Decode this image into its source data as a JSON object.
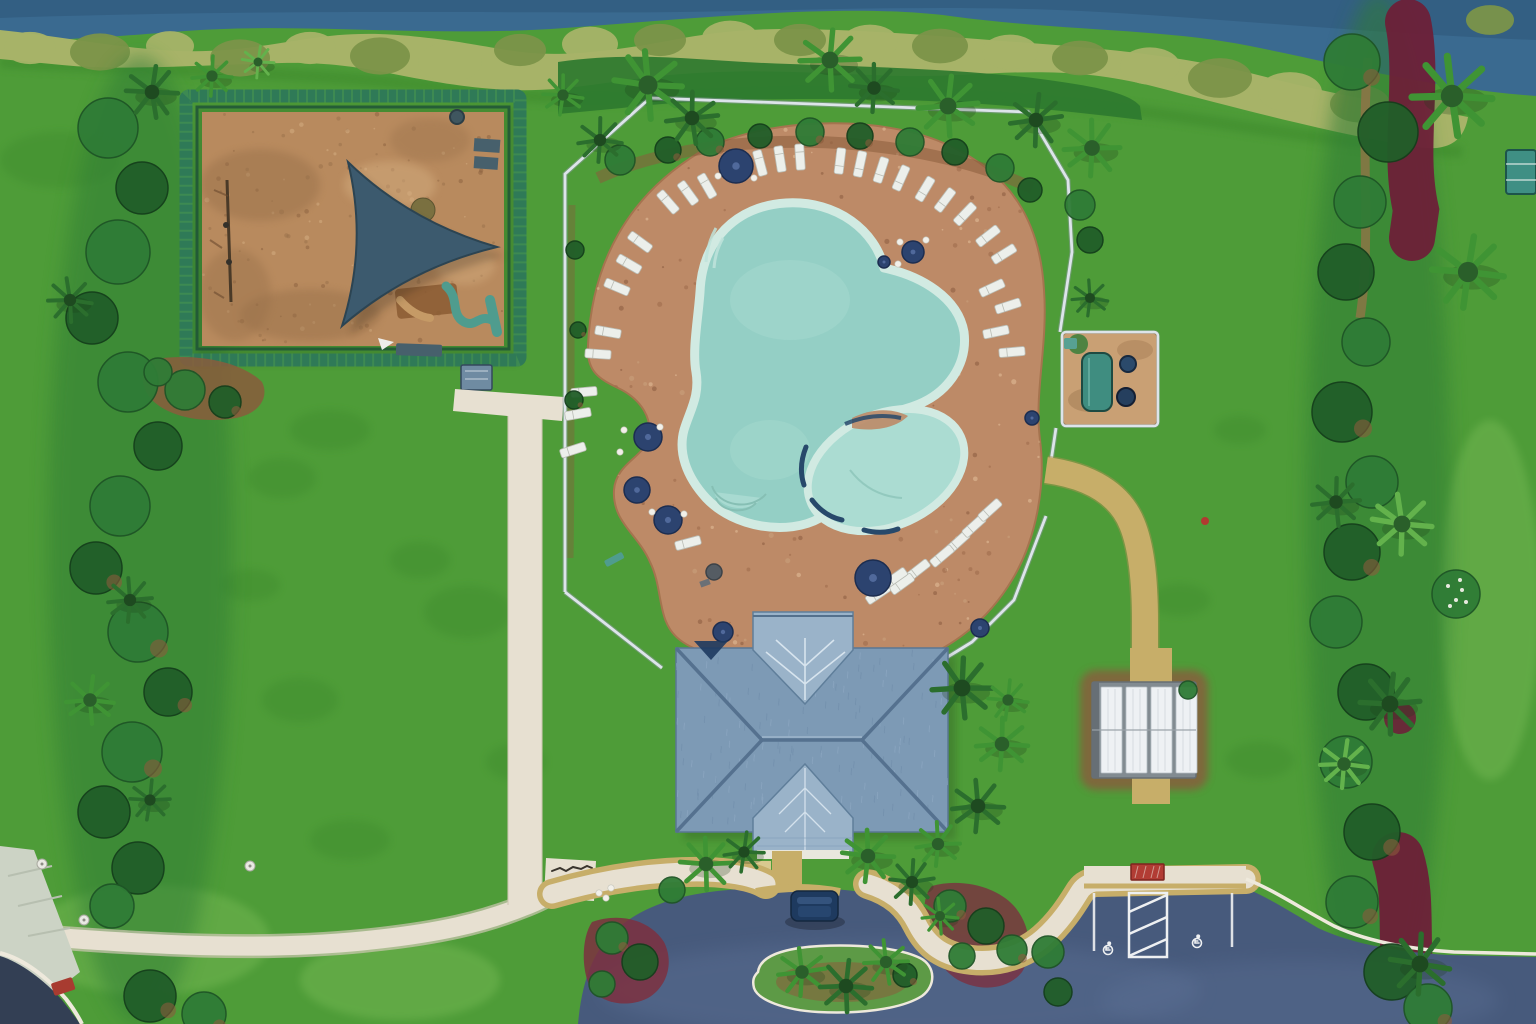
{
  "meta": {
    "width": 1536,
    "height": 1024,
    "scene": "aerial-drone-photo",
    "subject": "community amenity center: free-form pool with paver deck and lounge chairs, playground with shade sail, hip-roof clubhouse, mail pavilion, equipment enclosure, parking lot with accessible stalls, lawns, hedges and canal"
  },
  "palette": {
    "grass": "#4e9c38",
    "grassLight": "#65b148",
    "grassDark": "#3a872c",
    "grassPale": "#7cbd58",
    "water": "#3a6a90",
    "waterDark": "#2d5578",
    "hedge": "#a7b368",
    "hedgeDark": "#7b9449",
    "denseHedge": "#2e7a2f",
    "shrub": "#2f7c36",
    "shrubDark": "#215e29",
    "shrubLight": "#5aa84a",
    "palm": "#3f9434",
    "palmDark": "#2b6e2d",
    "palmLight": "#63b24c",
    "mulch": "#8a5c3c",
    "mulchRed": "#7c3040",
    "burgundy": "#6d2038",
    "dirt": "#9b7148",
    "playMulch": "#b88a5e",
    "playMulchDark": "#97704a",
    "playMulchLight": "#d3ac7e",
    "playHedge": "#2f7a57",
    "playHedgeDark": "#1d5038",
    "sail": "#3c5a6e",
    "sailShadow": "#2c4452",
    "equipTeal": "#4f9c8e",
    "equipBrown": "#8a5a33",
    "benchSlate": "#47606c",
    "gateBlue": "#6f8ba2",
    "deck": "#bd8a67",
    "deckDark": "#9c6a4b",
    "deckLight": "#e3c09b",
    "poolWater": "#94cfc5",
    "poolWaterLight": "#abdcd2",
    "coping": "#d1eae2",
    "spaRim": "#27496b",
    "poolStep": "#bfe3da",
    "fence": "#dde4ea",
    "fenceShadow": "#8d9aa3",
    "sidewalk": "#e7e0d1",
    "sidewalkEdge": "#cfc7b4",
    "pathTan": "#c7ae69",
    "pathTanDark": "#a98f4f",
    "asphalt": "#475a7c",
    "asphaltLight": "#60759a",
    "roadDark": "#333f54",
    "curb": "#eee9dc",
    "stripe": "#eef0f2",
    "carNavy": "#1e3a5f",
    "carNavyLight": "#3a5a85",
    "navy": "#2c436f",
    "navyDark": "#1c2d50",
    "lounger": "#ecefeb",
    "loungerEdge": "#b9bcb4",
    "roof": "#7d9ab5",
    "roofLight": "#9ab3c9",
    "roofDark": "#55718f",
    "roofVein": "#dee9f2",
    "wallWhite": "#e9e7dd",
    "pavFrame": "#828b91",
    "pavPanel": "#eef1f4",
    "pavPanelLine": "#b6bfc5",
    "sand": "#c9a074",
    "tealUnit": "#3f8d80",
    "redSign": "#b23c34",
    "redObj": "#a83b30",
    "tableTeal": "#3f8f84",
    "grillGray": "#555c63",
    "white": "#f2f0e9"
  },
  "objects": {
    "loungers": [
      [
        668,
        202,
        49
      ],
      [
        688,
        193,
        54
      ],
      [
        707,
        186,
        60
      ],
      [
        760,
        163,
        75
      ],
      [
        780,
        159,
        81
      ],
      [
        800,
        157,
        86
      ],
      [
        840,
        161,
        -83
      ],
      [
        860,
        164,
        -78
      ],
      [
        881,
        170,
        -72
      ],
      [
        901,
        178,
        -66
      ],
      [
        925,
        189,
        -59
      ],
      [
        945,
        200,
        -53
      ],
      [
        965,
        214,
        -46
      ],
      [
        988,
        236,
        -38
      ],
      [
        1004,
        254,
        -32
      ],
      [
        992,
        288,
        -25
      ],
      [
        1008,
        306,
        -18
      ],
      [
        996,
        332,
        -12
      ],
      [
        1012,
        352,
        -5
      ],
      [
        640,
        242,
        36
      ],
      [
        629,
        264,
        30
      ],
      [
        617,
        287,
        23
      ],
      [
        608,
        332,
        10
      ],
      [
        598,
        354,
        4
      ],
      [
        584,
        392,
        -5
      ],
      [
        578,
        414,
        -10
      ],
      [
        573,
        450,
        -18
      ],
      [
        688,
        543,
        -15
      ],
      [
        958,
        542,
        -42
      ],
      [
        974,
        526,
        -42
      ],
      [
        990,
        510,
        -42
      ],
      [
        942,
        556,
        -40
      ],
      [
        918,
        570,
        -38
      ],
      [
        902,
        584,
        -36
      ],
      [
        878,
        594,
        -34
      ],
      [
        895,
        578,
        -35
      ]
    ],
    "umbrellas": [
      [
        736,
        166,
        17
      ],
      [
        648,
        437,
        14
      ],
      [
        637,
        490,
        13
      ],
      [
        668,
        520,
        14
      ],
      [
        873,
        578,
        18
      ],
      [
        723,
        632,
        10
      ],
      [
        980,
        628,
        9
      ],
      [
        913,
        252,
        11
      ],
      [
        884,
        262,
        6
      ],
      [
        1032,
        418,
        7
      ]
    ],
    "white_dots": [
      [
        718,
        176
      ],
      [
        754,
        178
      ],
      [
        900,
        242
      ],
      [
        926,
        240
      ],
      [
        898,
        264
      ],
      [
        624,
        430
      ],
      [
        660,
        427
      ],
      [
        620,
        452
      ],
      [
        652,
        512
      ],
      [
        684,
        514
      ],
      [
        599,
        893
      ],
      [
        611,
        888
      ],
      [
        606,
        898
      ]
    ],
    "utility_dots": [
      [
        42,
        864
      ],
      [
        250,
        866
      ],
      [
        84,
        920
      ]
    ],
    "palms": [
      [
        648,
        85,
        34,
        "n"
      ],
      [
        692,
        118,
        26,
        "d"
      ],
      [
        830,
        60,
        30,
        "n"
      ],
      [
        874,
        88,
        24,
        "d"
      ],
      [
        948,
        106,
        30,
        "n"
      ],
      [
        1036,
        120,
        26,
        "d"
      ],
      [
        1092,
        148,
        28,
        "n"
      ],
      [
        600,
        140,
        22,
        "d"
      ],
      [
        563,
        95,
        20,
        "n"
      ],
      [
        962,
        688,
        30,
        "d"
      ],
      [
        1002,
        744,
        26,
        "n"
      ],
      [
        978,
        806,
        26,
        "d"
      ],
      [
        938,
        844,
        22,
        "n"
      ],
      [
        1008,
        700,
        20,
        "n"
      ],
      [
        706,
        864,
        26,
        "n"
      ],
      [
        744,
        852,
        20,
        "d"
      ],
      [
        868,
        856,
        26,
        "n"
      ],
      [
        912,
        882,
        22,
        "d"
      ],
      [
        940,
        916,
        18,
        "n"
      ],
      [
        802,
        972,
        24,
        "n"
      ],
      [
        846,
        986,
        26,
        "d"
      ],
      [
        886,
        962,
        22,
        "n"
      ],
      [
        1452,
        96,
        40,
        "n"
      ],
      [
        1468,
        272,
        36,
        "n"
      ],
      [
        1402,
        524,
        30,
        "l"
      ],
      [
        1336,
        502,
        24,
        "d"
      ],
      [
        1390,
        704,
        30,
        "d"
      ],
      [
        1344,
        764,
        24,
        "l"
      ],
      [
        1420,
        964,
        30,
        "d"
      ],
      [
        152,
        92,
        26,
        "d"
      ],
      [
        212,
        76,
        20,
        "n"
      ],
      [
        258,
        62,
        16,
        "l"
      ],
      [
        1090,
        298,
        18,
        "d"
      ],
      [
        70,
        300,
        22,
        "d"
      ],
      [
        130,
        600,
        22,
        "d"
      ],
      [
        90,
        700,
        24,
        "n"
      ],
      [
        150,
        800,
        20,
        "d"
      ]
    ],
    "bushes": [
      [
        108,
        128,
        30,
        "n"
      ],
      [
        142,
        188,
        26,
        "d"
      ],
      [
        118,
        252,
        32,
        "n"
      ],
      [
        92,
        318,
        26,
        "d"
      ],
      [
        128,
        382,
        30,
        "n"
      ],
      [
        158,
        446,
        24,
        "d"
      ],
      [
        120,
        506,
        30,
        "n"
      ],
      [
        96,
        568,
        26,
        "d"
      ],
      [
        138,
        632,
        30,
        "n"
      ],
      [
        168,
        692,
        24,
        "d"
      ],
      [
        132,
        752,
        30,
        "n"
      ],
      [
        104,
        812,
        26,
        "d"
      ],
      [
        138,
        868,
        26,
        "d"
      ],
      [
        112,
        906,
        22,
        "n"
      ],
      [
        150,
        996,
        26,
        "d"
      ],
      [
        204,
        1014,
        22,
        "n"
      ],
      [
        1352,
        62,
        28,
        "n"
      ],
      [
        1388,
        132,
        30,
        "d"
      ],
      [
        1360,
        202,
        26,
        "n"
      ],
      [
        1346,
        272,
        28,
        "d"
      ],
      [
        1366,
        342,
        24,
        "n"
      ],
      [
        1342,
        412,
        30,
        "d"
      ],
      [
        1372,
        482,
        26,
        "n"
      ],
      [
        1352,
        552,
        28,
        "d"
      ],
      [
        1336,
        622,
        26,
        "n"
      ],
      [
        1366,
        692,
        28,
        "d"
      ],
      [
        1346,
        762,
        26,
        "n"
      ],
      [
        1372,
        832,
        28,
        "d"
      ],
      [
        1352,
        902,
        26,
        "n"
      ],
      [
        1392,
        972,
        28,
        "d"
      ],
      [
        1428,
        1008,
        24,
        "n"
      ],
      [
        612,
        938,
        16,
        "n"
      ],
      [
        640,
        962,
        18,
        "d"
      ],
      [
        602,
        984,
        13,
        "n"
      ],
      [
        950,
        906,
        16,
        "n"
      ],
      [
        986,
        926,
        18,
        "d"
      ],
      [
        1012,
        950,
        15,
        "n"
      ],
      [
        962,
        956,
        13,
        "n"
      ],
      [
        672,
        890,
        13,
        "n"
      ],
      [
        1048,
        952,
        16,
        "n"
      ],
      [
        1058,
        992,
        14,
        "d"
      ],
      [
        1188,
        690,
        9,
        "n"
      ],
      [
        185,
        390,
        20,
        "n"
      ],
      [
        225,
        402,
        16,
        "d"
      ],
      [
        158,
        372,
        14,
        "n"
      ],
      [
        1080,
        205,
        15,
        "n"
      ],
      [
        1090,
        240,
        13,
        "d"
      ],
      [
        905,
        975,
        12,
        "d"
      ],
      [
        575,
        250,
        9,
        "d"
      ],
      [
        578,
        330,
        8,
        "d"
      ],
      [
        574,
        400,
        9,
        "d"
      ],
      [
        620,
        160,
        15,
        "n"
      ],
      [
        668,
        150,
        13,
        "d"
      ],
      [
        710,
        142,
        14,
        "n"
      ],
      [
        760,
        136,
        12,
        "d"
      ],
      [
        810,
        132,
        14,
        "n"
      ],
      [
        860,
        136,
        13,
        "d"
      ],
      [
        910,
        142,
        14,
        "n"
      ],
      [
        955,
        152,
        13,
        "d"
      ],
      [
        1000,
        168,
        14,
        "n"
      ],
      [
        1030,
        190,
        12,
        "d"
      ],
      [
        1456,
        594,
        24,
        "n"
      ]
    ],
    "hedge_clumps": [
      [
        30,
        48,
        26,
        0
      ],
      [
        100,
        52,
        30,
        1
      ],
      [
        170,
        46,
        24,
        0
      ],
      [
        240,
        58,
        30,
        1
      ],
      [
        310,
        48,
        26,
        0
      ],
      [
        380,
        56,
        30,
        1
      ],
      [
        450,
        62,
        32,
        0
      ],
      [
        520,
        50,
        26,
        1
      ],
      [
        590,
        44,
        28,
        0
      ],
      [
        660,
        40,
        26,
        1
      ],
      [
        730,
        38,
        28,
        0
      ],
      [
        800,
        40,
        26,
        1
      ],
      [
        870,
        42,
        28,
        0
      ],
      [
        940,
        46,
        28,
        1
      ],
      [
        1010,
        52,
        28,
        0
      ],
      [
        1080,
        58,
        28,
        1
      ],
      [
        1150,
        66,
        30,
        0
      ],
      [
        1220,
        78,
        32,
        1
      ],
      [
        1290,
        92,
        32,
        0
      ],
      [
        1360,
        104,
        30,
        1
      ],
      [
        1430,
        116,
        28,
        0
      ],
      [
        1490,
        20,
        24,
        1
      ]
    ],
    "grass_patches": [
      [
        468,
        612,
        44,
        26,
        "d"
      ],
      [
        300,
        700,
        38,
        22,
        "d"
      ],
      [
        516,
        762,
        30,
        18,
        "d"
      ],
      [
        282,
        478,
        34,
        20,
        "d"
      ],
      [
        420,
        560,
        30,
        18,
        "d"
      ],
      [
        350,
        840,
        40,
        20,
        "d"
      ],
      [
        250,
        585,
        30,
        16,
        "d"
      ],
      [
        1240,
        430,
        26,
        14,
        "d"
      ],
      [
        1180,
        600,
        30,
        16,
        "d"
      ],
      [
        1260,
        760,
        34,
        18,
        "d"
      ],
      [
        330,
        430,
        40,
        20,
        "d"
      ],
      [
        150,
        940,
        120,
        55,
        "l"
      ],
      [
        400,
        980,
        100,
        40,
        "l"
      ],
      [
        1490,
        600,
        50,
        180,
        "l"
      ],
      [
        60,
        160,
        60,
        28,
        "d"
      ]
    ],
    "flower_dots": [
      [
        1448,
        586
      ],
      [
        1462,
        590
      ],
      [
        1456,
        600
      ],
      [
        1466,
        602
      ],
      [
        1450,
        606
      ],
      [
        1460,
        580
      ]
    ]
  }
}
